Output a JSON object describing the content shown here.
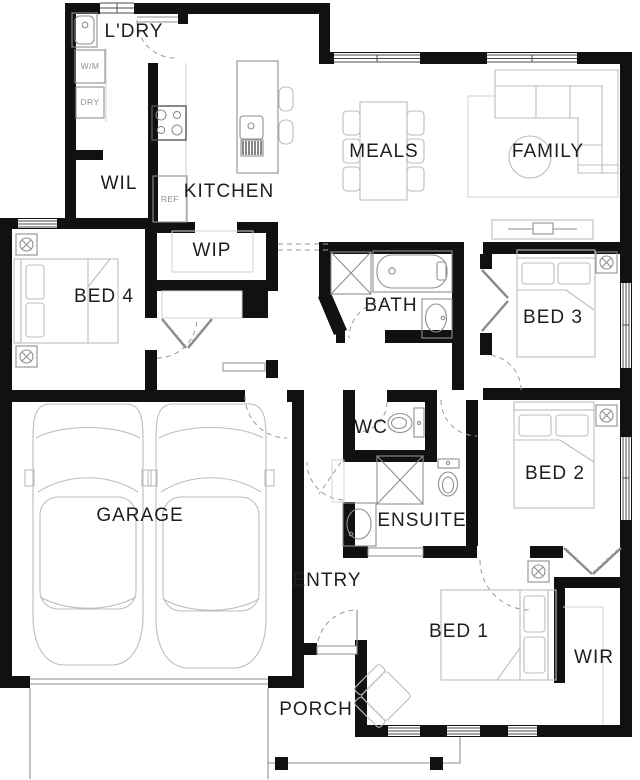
{
  "plan": {
    "type": "residential-floor-plan",
    "rooms": {
      "ldry": {
        "label": "L'DRY"
      },
      "wil": {
        "label": "WIL"
      },
      "kitchen": {
        "label": "KITCHEN"
      },
      "wip": {
        "label": "WIP"
      },
      "meals": {
        "label": "MEALS"
      },
      "family": {
        "label": "FAMILY"
      },
      "bed4": {
        "label": "BED 4"
      },
      "bath": {
        "label": "BATH"
      },
      "bed3": {
        "label": "BED 3"
      },
      "wc": {
        "label": "WC"
      },
      "bed2": {
        "label": "BED 2"
      },
      "garage": {
        "label": "GARAGE"
      },
      "ensuite": {
        "label": "ENSUITE"
      },
      "entry": {
        "label": "ENTRY"
      },
      "bed1": {
        "label": "BED 1"
      },
      "wir": {
        "label": "WIR"
      },
      "porch": {
        "label": "PORCH"
      }
    },
    "appliances": {
      "wm": {
        "label": "W/M"
      },
      "dry": {
        "label": "DRY"
      },
      "ref": {
        "label": "REF"
      }
    },
    "fixtures": [
      "laundry-tub",
      "washing-machine",
      "dryer",
      "cooktop",
      "refrigerator",
      "island-bench",
      "island-sink",
      "dishwasher",
      "bar-stools",
      "pantry-shelves",
      "linen-cupboard",
      "dining-table",
      "dining-chairs",
      "sofa",
      "rug",
      "round-side-table",
      "tv-unit",
      "double-bed",
      "bedside-lamp",
      "bathtub",
      "shower",
      "vanity-basin",
      "toilet",
      "robe-bifold-doors",
      "car",
      "armchair",
      "porch-posts",
      "driveway",
      "garage-door"
    ],
    "colors": {
      "wall": "#111111",
      "fixture_line": "#8f8f8f",
      "furniture_line": "#bdbdbd",
      "label_text": "#1e1e1e",
      "appliance_text": "#8f8f8f",
      "background": "#ffffff"
    }
  }
}
